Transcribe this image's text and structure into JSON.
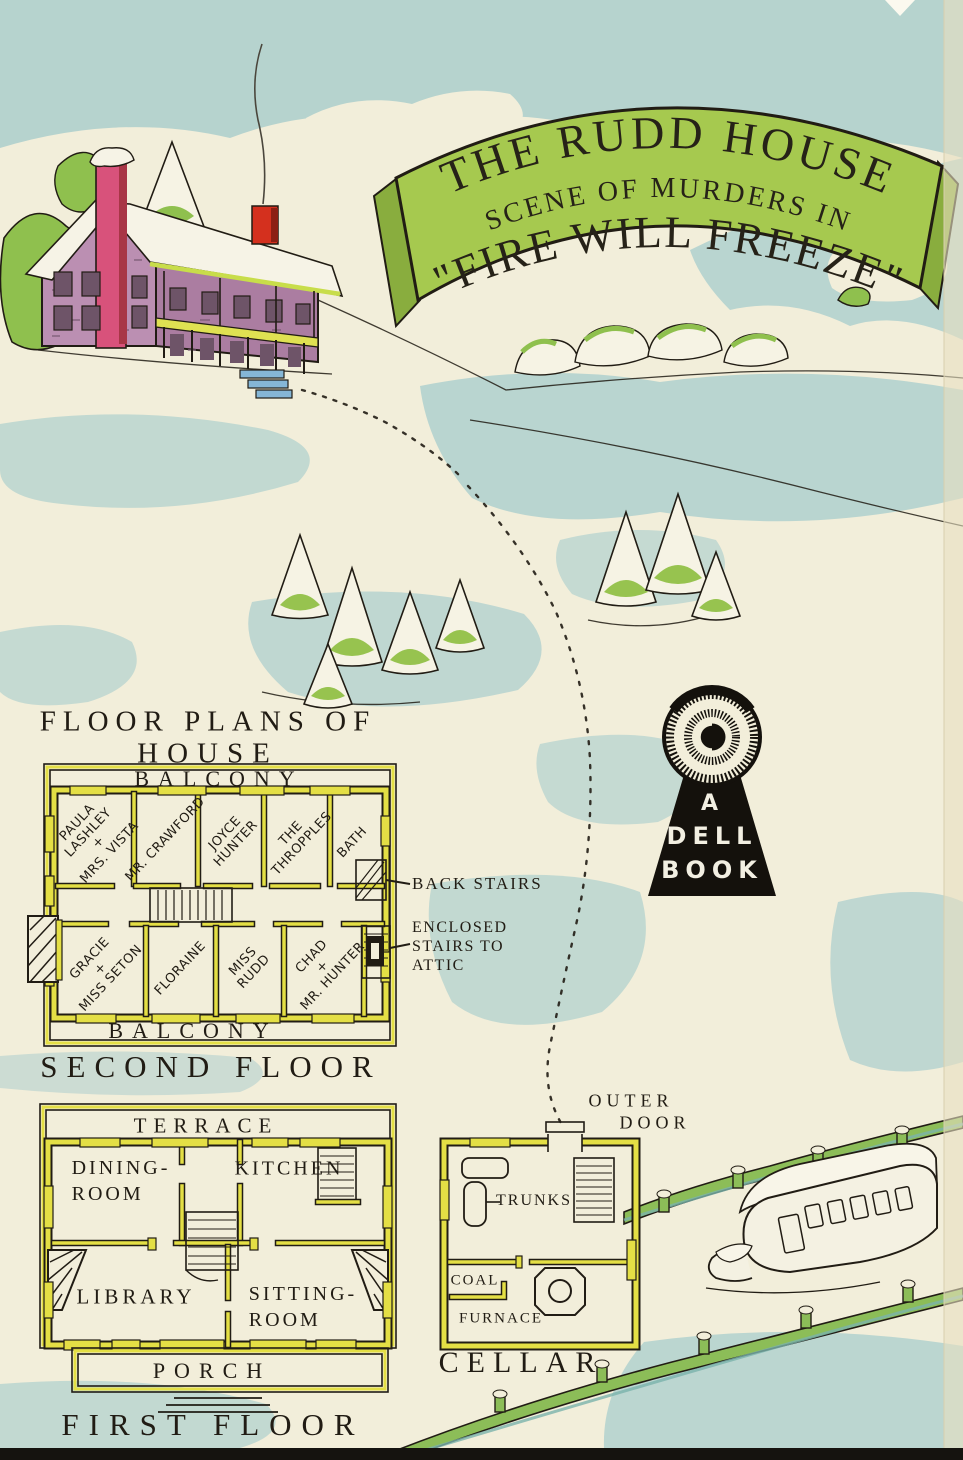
{
  "banner": {
    "line1": "THE RUDD HOUSE",
    "line2": "SCENE OF MURDERS IN",
    "line3": "\"FIRE WILL FREEZE\""
  },
  "title": {
    "line1": "FLOOR PLANS OF",
    "line2": "HOUSE"
  },
  "second_floor": {
    "balcony_top": "BALCONY",
    "balcony_bottom": "BALCONY",
    "caption": "SECOND FLOOR",
    "rooms_top": [
      {
        "lines": [
          "PAULA",
          "LASHLEY",
          "+",
          "MRS. VISTA"
        ]
      },
      {
        "lines": [
          "MR. CRAWFORD"
        ]
      },
      {
        "lines": [
          "JOYCE",
          "HUNTER"
        ]
      },
      {
        "lines": [
          "THE",
          "THROPPLES"
        ]
      },
      {
        "lines": [
          "BATH"
        ]
      }
    ],
    "rooms_bottom": [
      {
        "lines": [
          "GRACIE",
          "+",
          "MISS SETON"
        ]
      },
      {
        "lines": [
          "FLORAINE"
        ]
      },
      {
        "lines": [
          "MISS",
          "RUDD"
        ]
      },
      {
        "lines": [
          "CHAD",
          "+",
          "MR. HUNTER"
        ]
      }
    ],
    "back_stairs_label": "BACK STAIRS",
    "attic_stairs_label": {
      "line1": "ENCLOSED",
      "line2": "STAIRS TO",
      "line3": "ATTIC"
    }
  },
  "first_floor": {
    "terrace": "TERRACE",
    "dining_room": {
      "line1": "DINING-",
      "line2": "ROOM"
    },
    "kitchen": "KITCHEN",
    "library": "LIBRARY",
    "sitting_room": {
      "line1": "SITTING-",
      "line2": "ROOM"
    },
    "porch": "PORCH",
    "caption": "FIRST FLOOR"
  },
  "cellar": {
    "outer_door": {
      "line1": "OUTER",
      "line2": "DOOR"
    },
    "trunks": "TRUNKS",
    "coal": "COAL",
    "furnace": "FURNACE",
    "caption": "CELLAR"
  },
  "logo": {
    "line1": "A",
    "line2": "DELL",
    "line3": "BOOK"
  },
  "colors": {
    "paper": "#f2eeda",
    "wash_blue": "#b2d1ce",
    "banner_green": "#a6c94f",
    "plan_wall_yellow": "#e4df45",
    "ink": "#211c14",
    "house_stone": "#bb8fb2",
    "chimney_pink": "#d8527b",
    "chimney_red": "#d4301e",
    "tree_green": "#8fc04e",
    "fence_green": "#8cbd58",
    "logo_black": "#14110c"
  }
}
